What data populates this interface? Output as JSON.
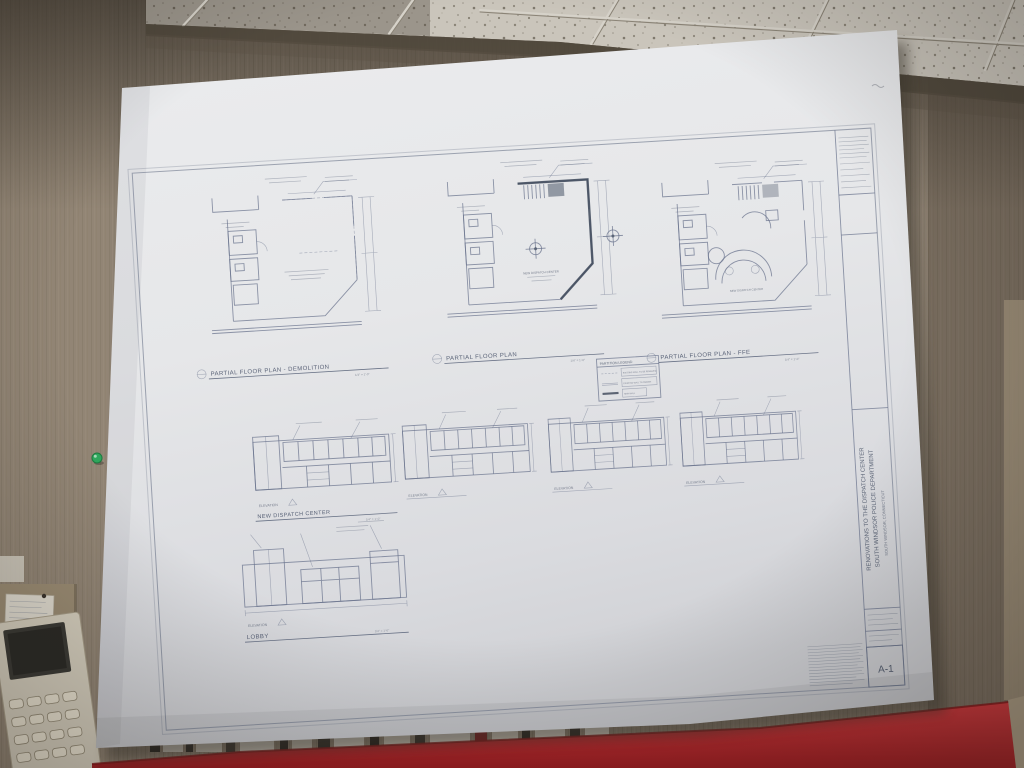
{
  "scene": {
    "description": "Photograph of a large architectural drawing sheet pinned to a fabric-covered office wall, beneath a suspended acoustic-tile ceiling, with a telephone keypad, pinned notes and a red shelf with binders at the bottom",
    "colors": {
      "wall": "#8e8273",
      "wall_dark": "#5f5548",
      "ceiling_tile": "#cac5bb",
      "paper": "#e6e7e9",
      "drawing_line": "#5f6a7e",
      "shelf_red": "#c0282c",
      "pushpin_green": "#2ea45b",
      "phone_body": "#d8d1c0"
    }
  },
  "sheet": {
    "plans": [
      {
        "title": "PARTIAL FLOOR PLAN - DEMOLITION",
        "scale": "1/4\" = 1'-0\""
      },
      {
        "title": "PARTIAL FLOOR PLAN",
        "scale": "1/4\" = 1'-0\""
      },
      {
        "title": "PARTIAL FLOOR PLAN - FFE",
        "scale": "1/4\" = 1'-0\""
      }
    ],
    "room_label": "NEW DISPATCH CENTER",
    "legend": {
      "title": "PARTITION LEGEND",
      "items": [
        {
          "label": "EXISTING WALL TO BE REMOVED"
        },
        {
          "label": "EXISTING WALL TO REMAIN"
        },
        {
          "label": "NEW WALL"
        }
      ]
    },
    "elevations": [
      {
        "label": "ELEVATION"
      },
      {
        "label": "ELEVATION"
      },
      {
        "label": "ELEVATION"
      },
      {
        "label": "ELEVATION"
      }
    ],
    "elevation_group_title": "NEW DISPATCH CENTER",
    "lobby": {
      "label": "ELEVATION",
      "title": "LOBBY",
      "scale": "1/4\" = 1'-0\""
    },
    "title_block": {
      "project_line1": "RENOVATIONS TO THE DISPATCH CENTER",
      "project_line2": "SOUTH WINDSOR POLICE DEPARTMENT",
      "project_line3": "SOUTH WINDSOR, CONNECTICUT",
      "sheet_number": "A-1"
    }
  }
}
